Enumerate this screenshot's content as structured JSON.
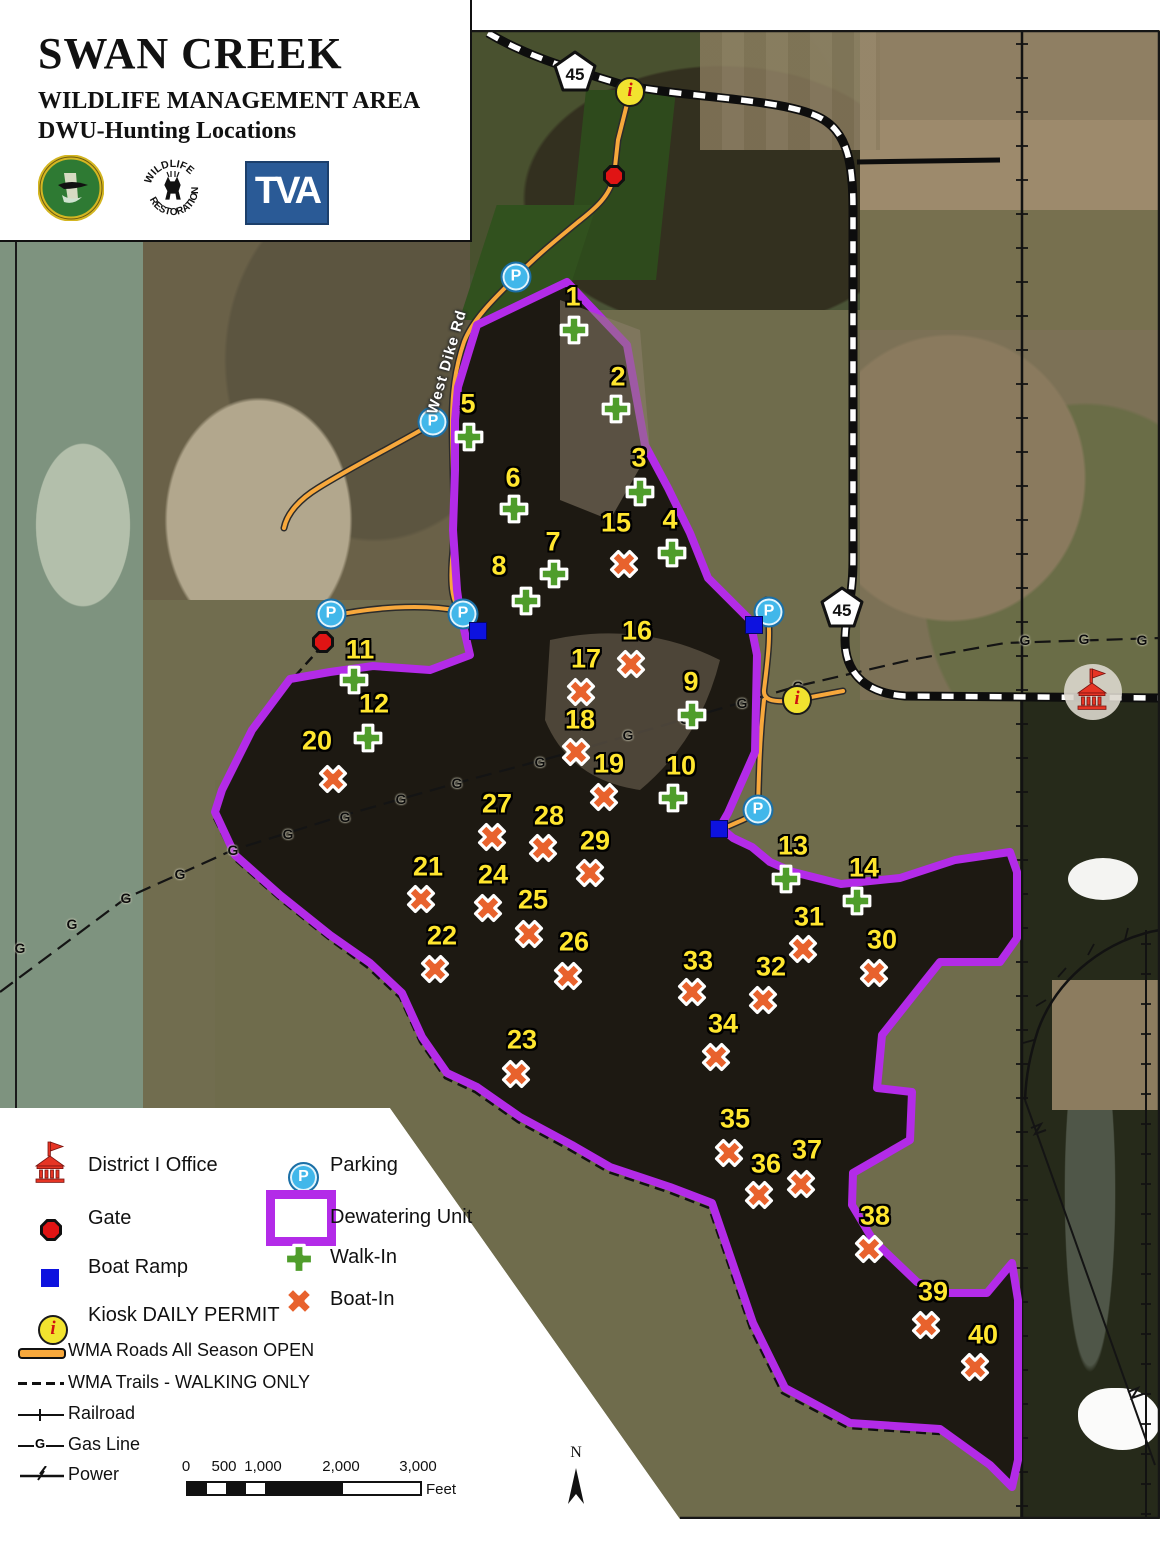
{
  "title_block": {
    "title": "SWAN CREEK",
    "subtitle1": "WILDLIFE MANAGEMENT AREA",
    "subtitle2": "DWU-Hunting Locations",
    "logos": [
      {
        "name": "alabama-wildlife-logo",
        "label": "ALABAMA"
      },
      {
        "name": "wildlife-restoration-logo",
        "top_text": "WILDLIFE",
        "bottom_text": "RESTORATION"
      },
      {
        "name": "tva-logo",
        "label": "TVA"
      }
    ]
  },
  "map": {
    "road_labels": [
      {
        "text": "West Dike Rd",
        "x": 447,
        "y": 362,
        "rotate": -74
      }
    ],
    "highway_shields": [
      {
        "text": "45",
        "x": 575,
        "y": 71
      },
      {
        "text": "45",
        "x": 842,
        "y": 607
      }
    ],
    "markers": {
      "walk_in": [
        {
          "n": "1",
          "x": 558,
          "y": 314,
          "lx": 573,
          "ly": 297
        },
        {
          "n": "2",
          "x": 600,
          "y": 393,
          "lx": 618,
          "ly": 377
        },
        {
          "n": "3",
          "x": 624,
          "y": 476,
          "lx": 639,
          "ly": 458
        },
        {
          "n": "4",
          "x": 656,
          "y": 537,
          "lx": 670,
          "ly": 520
        },
        {
          "n": "5",
          "x": 453,
          "y": 421,
          "lx": 468,
          "ly": 404
        },
        {
          "n": "6",
          "x": 498,
          "y": 493,
          "lx": 513,
          "ly": 478
        },
        {
          "n": "7",
          "x": 538,
          "y": 558,
          "lx": 553,
          "ly": 542
        },
        {
          "n": "8",
          "x": 510,
          "y": 585,
          "lx": 499,
          "ly": 566
        },
        {
          "n": "9",
          "x": 676,
          "y": 699,
          "lx": 691,
          "ly": 682
        },
        {
          "n": "10",
          "x": 657,
          "y": 782,
          "lx": 681,
          "ly": 766
        },
        {
          "n": "11",
          "x": 338,
          "y": 664,
          "lx": 360,
          "ly": 650
        },
        {
          "n": "12",
          "x": 352,
          "y": 722,
          "lx": 374,
          "ly": 704
        },
        {
          "n": "13",
          "x": 770,
          "y": 863,
          "lx": 793,
          "ly": 846
        },
        {
          "n": "14",
          "x": 841,
          "y": 885,
          "lx": 864,
          "ly": 868
        }
      ],
      "boat_in": [
        {
          "n": "15",
          "x": 608,
          "y": 548,
          "lx": 616,
          "ly": 523
        },
        {
          "n": "16",
          "x": 615,
          "y": 648,
          "lx": 637,
          "ly": 631
        },
        {
          "n": "17",
          "x": 565,
          "y": 676,
          "lx": 586,
          "ly": 659
        },
        {
          "n": "18",
          "x": 560,
          "y": 736,
          "lx": 580,
          "ly": 720
        },
        {
          "n": "19",
          "x": 588,
          "y": 781,
          "lx": 609,
          "ly": 764
        },
        {
          "n": "20",
          "x": 317,
          "y": 763,
          "lx": 317,
          "ly": 741
        },
        {
          "n": "21",
          "x": 405,
          "y": 883,
          "lx": 428,
          "ly": 867
        },
        {
          "n": "22",
          "x": 419,
          "y": 953,
          "lx": 442,
          "ly": 936
        },
        {
          "n": "23",
          "x": 500,
          "y": 1058,
          "lx": 522,
          "ly": 1040
        },
        {
          "n": "24",
          "x": 472,
          "y": 892,
          "lx": 493,
          "ly": 875
        },
        {
          "n": "25",
          "x": 513,
          "y": 918,
          "lx": 533,
          "ly": 900
        },
        {
          "n": "26",
          "x": 552,
          "y": 960,
          "lx": 574,
          "ly": 942
        },
        {
          "n": "27",
          "x": 476,
          "y": 821,
          "lx": 497,
          "ly": 804
        },
        {
          "n": "28",
          "x": 527,
          "y": 832,
          "lx": 549,
          "ly": 816
        },
        {
          "n": "29",
          "x": 574,
          "y": 857,
          "lx": 595,
          "ly": 841
        },
        {
          "n": "30",
          "x": 858,
          "y": 957,
          "lx": 882,
          "ly": 940
        },
        {
          "n": "31",
          "x": 787,
          "y": 933,
          "lx": 809,
          "ly": 917
        },
        {
          "n": "32",
          "x": 747,
          "y": 984,
          "lx": 771,
          "ly": 967
        },
        {
          "n": "33",
          "x": 676,
          "y": 976,
          "lx": 698,
          "ly": 961
        },
        {
          "n": "34",
          "x": 700,
          "y": 1041,
          "lx": 723,
          "ly": 1024
        },
        {
          "n": "35",
          "x": 713,
          "y": 1137,
          "lx": 735,
          "ly": 1119
        },
        {
          "n": "36",
          "x": 743,
          "y": 1179,
          "lx": 766,
          "ly": 1164
        },
        {
          "n": "37",
          "x": 785,
          "y": 1168,
          "lx": 807,
          "ly": 1150
        },
        {
          "n": "38",
          "x": 853,
          "y": 1233,
          "lx": 875,
          "ly": 1216
        },
        {
          "n": "39",
          "x": 910,
          "y": 1309,
          "lx": 933,
          "ly": 1292
        },
        {
          "n": "40",
          "x": 959,
          "y": 1351,
          "lx": 983,
          "ly": 1335
        }
      ]
    },
    "parking": [
      {
        "x": 516,
        "y": 277
      },
      {
        "x": 433,
        "y": 422
      },
      {
        "x": 331,
        "y": 614
      },
      {
        "x": 463,
        "y": 614
      },
      {
        "x": 769,
        "y": 612
      },
      {
        "x": 758,
        "y": 810
      }
    ],
    "boat_ramps": [
      {
        "x": 478,
        "y": 631
      },
      {
        "x": 754,
        "y": 625
      },
      {
        "x": 719,
        "y": 829
      }
    ],
    "gates": [
      {
        "x": 614,
        "y": 176
      },
      {
        "x": 323,
        "y": 642
      }
    ],
    "kiosks": [
      {
        "x": 630,
        "y": 92
      },
      {
        "x": 797,
        "y": 700
      }
    ],
    "kiosk_glyph": "i",
    "parking_glyph": "P",
    "office": {
      "x": 1092,
      "y": 690
    },
    "gas_labels": [
      [
        20,
        948
      ],
      [
        72,
        924
      ],
      [
        126,
        898
      ],
      [
        180,
        874
      ],
      [
        233,
        850
      ],
      [
        288,
        834
      ],
      [
        345,
        817
      ],
      [
        401,
        799
      ],
      [
        457,
        783
      ],
      [
        540,
        762
      ],
      [
        572,
        752
      ],
      [
        628,
        735
      ],
      [
        685,
        719
      ],
      [
        742,
        703
      ],
      [
        798,
        686
      ],
      [
        1025,
        640
      ],
      [
        1084,
        639
      ],
      [
        1142,
        640
      ]
    ]
  },
  "legend": {
    "col1": [
      {
        "icon": "office-icon",
        "label": "District I Office"
      },
      {
        "icon": "gate-icon",
        "label": "Gate"
      },
      {
        "icon": "boat-ramp-icon",
        "label": "Boat Ramp"
      },
      {
        "icon": "kiosk-icon",
        "label": "Kiosk DAILY PERMIT"
      },
      {
        "icon": "road-icon",
        "label": "WMA Roads All Season OPEN"
      },
      {
        "icon": "trail-icon",
        "label": "WMA Trails - WALKING ONLY"
      },
      {
        "icon": "railroad-icon",
        "label": "Railroad"
      },
      {
        "icon": "gasline-icon",
        "label": "Gas Line"
      },
      {
        "icon": "power-icon",
        "label": "Power"
      }
    ],
    "col2": [
      {
        "icon": "parking-icon",
        "label": "Parking"
      },
      {
        "icon": "dewatering-icon",
        "label": "Dewatering Unit"
      },
      {
        "icon": "walk-in-icon",
        "label": "Walk-In"
      },
      {
        "icon": "boat-in-icon",
        "label": "Boat-In"
      }
    ]
  },
  "scalebar": {
    "ticks": [
      "0",
      "500",
      "1,000",
      "2,000",
      "3,000"
    ],
    "unit": "Feet"
  },
  "north_label": "N",
  "colors": {
    "dewatering_purple": "#b32be8",
    "walk_in_green": "#4f9d2b",
    "boat_in_orange": "#e8622d",
    "label_yellow": "#ffe62e",
    "road_orange": "#f7a83c",
    "parking_blue": "#41b7ea",
    "ramp_blue": "#0d12df",
    "gate_red": "#e01414",
    "kiosk_yellow": "#f2e32f",
    "office_red": "#e63424"
  }
}
